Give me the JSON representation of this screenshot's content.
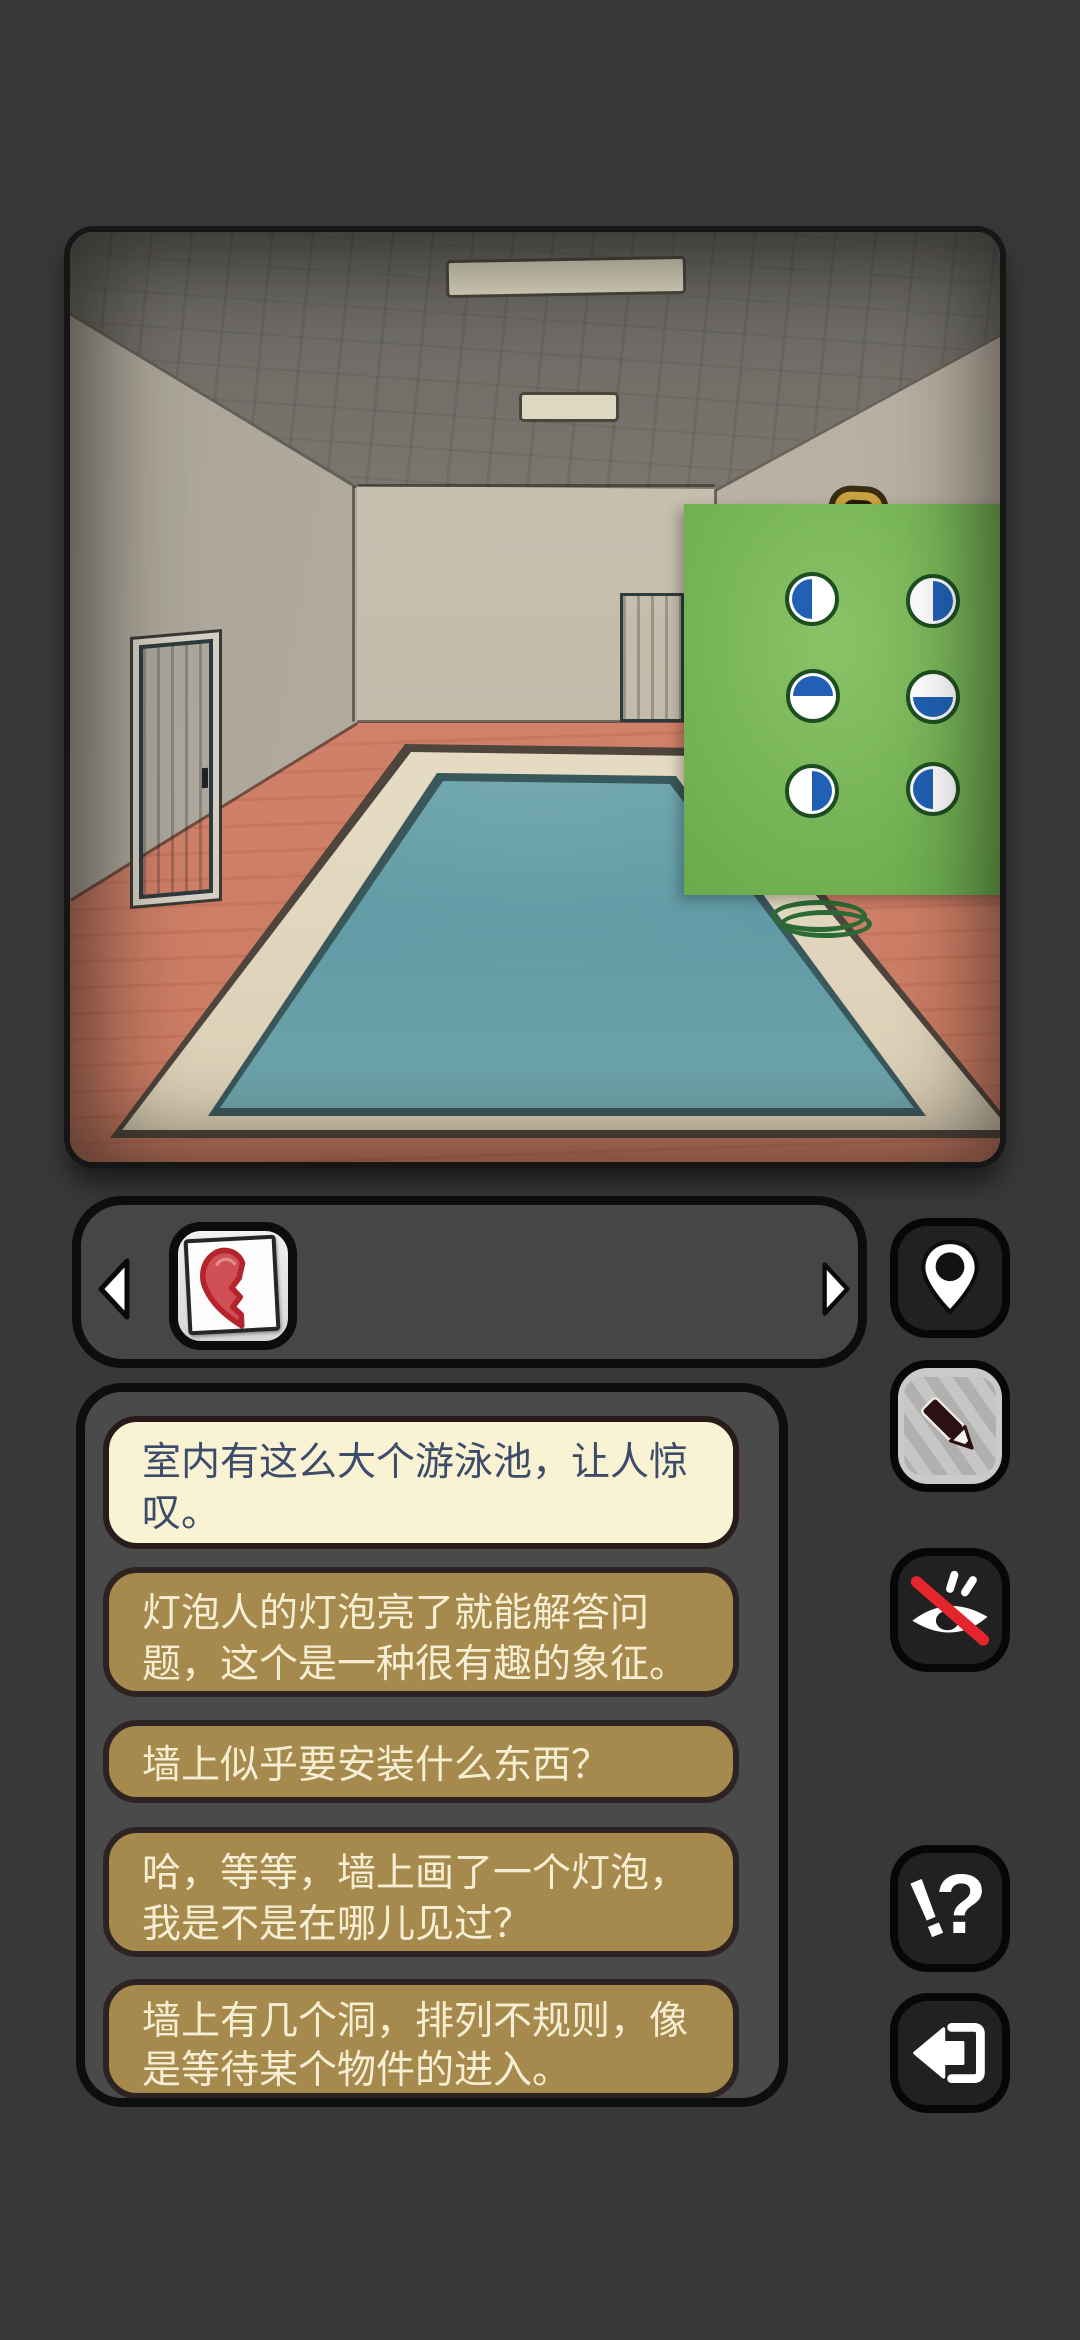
{
  "app": {
    "background_color": "#383838"
  },
  "scene": {
    "name": "indoor-pool-room",
    "puzzle_panel": {
      "background_color": "#74b254",
      "circle_blue": "#2160b5",
      "circle_ring": "#1d4e20",
      "circles": [
        {
          "row": 1,
          "col": 1,
          "blue_half": "left"
        },
        {
          "row": 1,
          "col": 2,
          "blue_half": "right"
        },
        {
          "row": 2,
          "col": 1,
          "blue_half": "top"
        },
        {
          "row": 2,
          "col": 2,
          "blue_half": "bottom"
        },
        {
          "row": 3,
          "col": 1,
          "blue_half": "right"
        },
        {
          "row": 3,
          "col": 2,
          "blue_half": "left"
        }
      ]
    }
  },
  "inventory": {
    "selected_item": "broken-heart-half",
    "item_color": "#c6373f"
  },
  "side_buttons": {
    "map_icon": "location-pin",
    "pencil_icon": "pencil",
    "hide_icon": "eye-off",
    "hint_exclamation": "!",
    "hint_question": "?",
    "back_icon": "back-arrow",
    "slash_color": "#e4252e"
  },
  "chat": {
    "bubble_cream_bg": "#f9f2d3",
    "bubble_olive_bg": "#a5894d",
    "text_cream": "#f6eed3",
    "text_dark": "#3d4c6b",
    "bubbles": [
      {
        "variant": "cream",
        "text": [
          "室内有这么大个游泳池，让人惊",
          "叹。"
        ]
      },
      {
        "variant": "olive",
        "text": [
          "灯泡人的灯泡亮了就能解答问",
          "题，这个是一种很有趣的象征。"
        ]
      },
      {
        "variant": "olive",
        "text": [
          "墙上似乎要安装什么东西？"
        ]
      },
      {
        "variant": "olive",
        "text": [
          "哈，等等，墙上画了一个灯泡，",
          "我是不是在哪儿见过？"
        ]
      },
      {
        "variant": "olive",
        "text": [
          "墙上有几个洞，排列不规则，像",
          "是等待某个物件的进入。"
        ]
      }
    ]
  }
}
